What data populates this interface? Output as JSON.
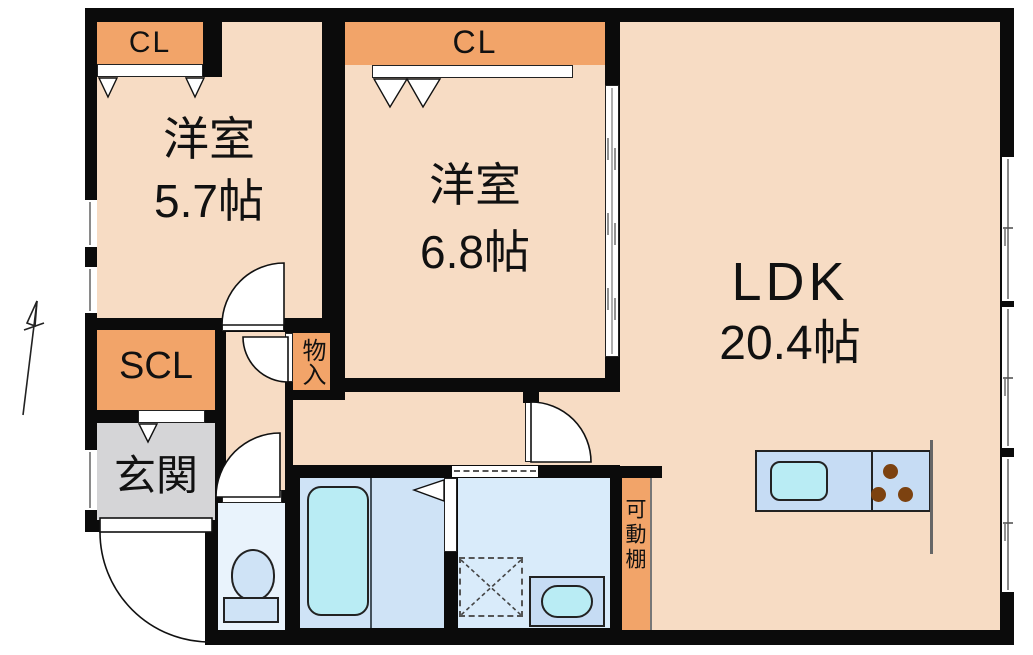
{
  "floorplan": {
    "rooms": [
      {
        "name": "洋室",
        "size": "5.7帖"
      },
      {
        "name": "洋室",
        "size": "6.8帖"
      },
      {
        "name": "LDK",
        "size": "20.4帖"
      }
    ],
    "labels": {
      "closet1": "CL",
      "closet2": "CL",
      "shoe_closet": "SCL",
      "entrance": "玄関",
      "storage": "物入",
      "movable_shelf": "可動棚"
    }
  },
  "colors": {
    "wall": "#0b0b0b",
    "floor": "#f7dcc4",
    "closet": "#f2a469",
    "entrance": "#d5d5d7",
    "toilet-floor": "#e9f3fc",
    "bath-floor": "#cfe3f6",
    "wash-floor": "#d9ebfa",
    "cyan": "#b9ecf4",
    "counter-blue": "#c6dcf4",
    "burner": "#7c4210",
    "window-line": "#8a8a8a"
  }
}
